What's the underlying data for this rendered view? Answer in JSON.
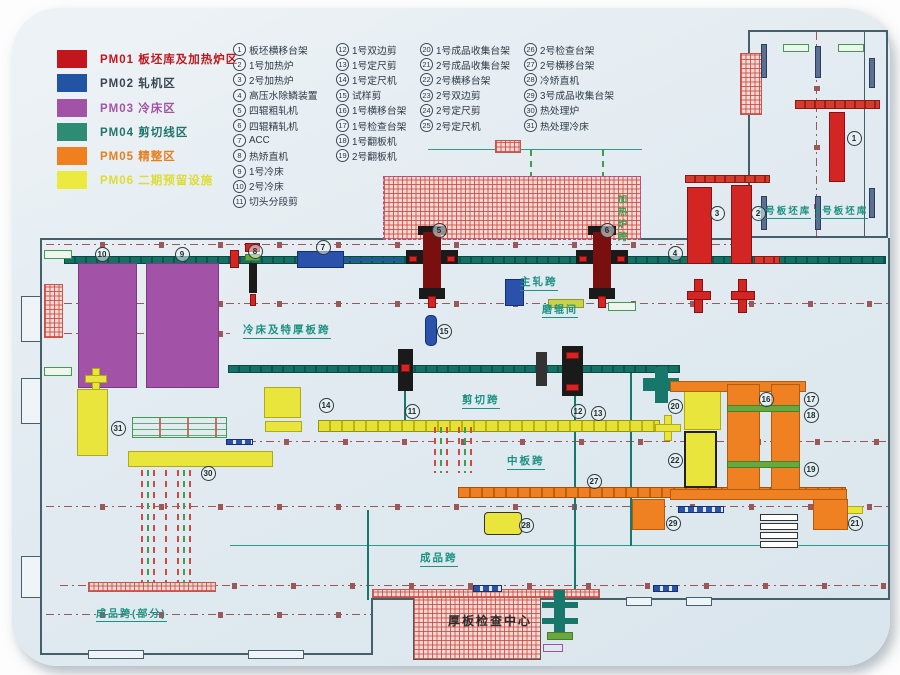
{
  "legend": {
    "items": [
      {
        "code": "PM01",
        "name": "板坯库及加热炉区",
        "swatch": "#c3161c",
        "text": "#c3161c"
      },
      {
        "code": "PM02",
        "name": "轧机区",
        "swatch": "#2155a4",
        "text": "#3a4652"
      },
      {
        "code": "PM03",
        "name": "冷床区",
        "swatch": "#a253a8",
        "text": "#a253a8"
      },
      {
        "code": "PM04",
        "name": "剪切线区",
        "swatch": "#2e8b74",
        "text": "#20756a"
      },
      {
        "code": "PM05",
        "name": "精整区",
        "swatch": "#f07f1f",
        "text": "#e87d1e"
      },
      {
        "code": "PM06",
        "name": "二期预留设施",
        "swatch": "#ece93f",
        "text": "#dedc30"
      }
    ]
  },
  "equipment": {
    "columns": [
      {
        "items": [
          {
            "num": "1",
            "label": "板坯横移台架"
          },
          {
            "num": "2",
            "label": "1号加热炉"
          },
          {
            "num": "3",
            "label": "2号加热炉"
          },
          {
            "num": "4",
            "label": "高压水除鳞装置"
          },
          {
            "num": "5",
            "label": "四辊粗轧机"
          },
          {
            "num": "6",
            "label": "四辊精轧机"
          },
          {
            "num": "7",
            "label": "ACC"
          },
          {
            "num": "8",
            "label": "热矫直机"
          },
          {
            "num": "9",
            "label": "1号冷床"
          },
          {
            "num": "10",
            "label": "2号冷床"
          },
          {
            "num": "11",
            "label": "切头分段剪"
          }
        ]
      },
      {
        "items": [
          {
            "num": "12",
            "label": "1号双边剪"
          },
          {
            "num": "13",
            "label": "1号定尺剪"
          },
          {
            "num": "14",
            "label": "1号定尺机"
          },
          {
            "num": "15",
            "label": "试样剪"
          },
          {
            "num": "16",
            "label": "1号横移台架"
          },
          {
            "num": "17",
            "label": "1号检查台架"
          },
          {
            "num": "18",
            "label": "1号翻板机"
          },
          {
            "num": "19",
            "label": "2号翻板机"
          }
        ]
      },
      {
        "items": [
          {
            "num": "20",
            "label": "1号成品收集台架"
          },
          {
            "num": "21",
            "label": "2号成品收集台架"
          },
          {
            "num": "22",
            "label": "2号横移台架"
          },
          {
            "num": "23",
            "label": "2号双边剪"
          },
          {
            "num": "24",
            "label": "2号定尺剪"
          },
          {
            "num": "25",
            "label": "2号定尺机"
          }
        ]
      },
      {
        "items": [
          {
            "num": "26",
            "label": "2号检查台架"
          },
          {
            "num": "27",
            "label": "2号横移台架"
          },
          {
            "num": "28",
            "label": "冷矫直机"
          },
          {
            "num": "29",
            "label": "3号成品收集台架"
          },
          {
            "num": "30",
            "label": "热处理炉"
          },
          {
            "num": "31",
            "label": "热处理冷床"
          }
        ]
      }
    ]
  },
  "bay_labels": [
    {
      "text": "冷床及特厚板跨",
      "x": 243,
      "y": 325,
      "color": "#1e9183",
      "size": 10.5,
      "underline": true
    },
    {
      "text": "主轧跨",
      "x": 520,
      "y": 277,
      "color": "#1e9183",
      "size": 10.5,
      "underline": true
    },
    {
      "text": "磨辊间",
      "x": 542,
      "y": 305,
      "color": "#1e9183",
      "size": 10,
      "underline": true
    },
    {
      "text": "加热炉跨",
      "x": 615,
      "y": 194,
      "color": "#3f9d4f",
      "size": 9.5,
      "underline": false,
      "vertical": true
    },
    {
      "text": "2号板坯库",
      "x": 758,
      "y": 207,
      "color": "#1e9183",
      "size": 9.5,
      "underline": true
    },
    {
      "text": "1号板坯库",
      "x": 815,
      "y": 207,
      "color": "#1e9183",
      "size": 9.5,
      "underline": true
    },
    {
      "text": "剪切跨",
      "x": 462,
      "y": 395,
      "color": "#1e9183",
      "size": 10.5,
      "underline": true
    },
    {
      "text": "中板跨",
      "x": 507,
      "y": 456,
      "color": "#1e9183",
      "size": 10.5,
      "underline": true
    },
    {
      "text": "成品跨",
      "x": 420,
      "y": 553,
      "color": "#1e9183",
      "size": 10.5,
      "underline": true
    },
    {
      "text": "成品跨(部分)",
      "x": 96,
      "y": 609,
      "color": "#1e9183",
      "size": 10,
      "underline": true
    },
    {
      "text": "厚板检查中心",
      "x": 448,
      "y": 615,
      "color": "#2b2b2b",
      "size": 12,
      "underline": false
    }
  ],
  "markers": [
    {
      "n": "1",
      "x": 853,
      "y": 137
    },
    {
      "n": "2",
      "x": 757,
      "y": 212
    },
    {
      "n": "3",
      "x": 716,
      "y": 212
    },
    {
      "n": "4",
      "x": 674,
      "y": 252
    },
    {
      "n": "5",
      "x": 438,
      "y": 229
    },
    {
      "n": "6",
      "x": 606,
      "y": 229
    },
    {
      "n": "7",
      "x": 322,
      "y": 246
    },
    {
      "n": "8",
      "x": 254,
      "y": 250
    },
    {
      "n": "9",
      "x": 181,
      "y": 253
    },
    {
      "n": "10",
      "x": 101,
      "y": 253
    },
    {
      "n": "11",
      "x": 411,
      "y": 410
    },
    {
      "n": "12",
      "x": 577,
      "y": 410
    },
    {
      "n": "13",
      "x": 597,
      "y": 412
    },
    {
      "n": "14",
      "x": 325,
      "y": 404
    },
    {
      "n": "15",
      "x": 443,
      "y": 330
    },
    {
      "n": "16",
      "x": 765,
      "y": 398
    },
    {
      "n": "17",
      "x": 810,
      "y": 398
    },
    {
      "n": "18",
      "x": 810,
      "y": 414
    },
    {
      "n": "19",
      "x": 810,
      "y": 468
    },
    {
      "n": "20",
      "x": 674,
      "y": 405
    },
    {
      "n": "21",
      "x": 854,
      "y": 522
    },
    {
      "n": "22",
      "x": 674,
      "y": 459
    },
    {
      "n": "27",
      "x": 593,
      "y": 480
    },
    {
      "n": "28",
      "x": 525,
      "y": 524
    },
    {
      "n": "29",
      "x": 672,
      "y": 522
    },
    {
      "n": "30",
      "x": 207,
      "y": 472
    },
    {
      "n": "31",
      "x": 117,
      "y": 427
    }
  ]
}
